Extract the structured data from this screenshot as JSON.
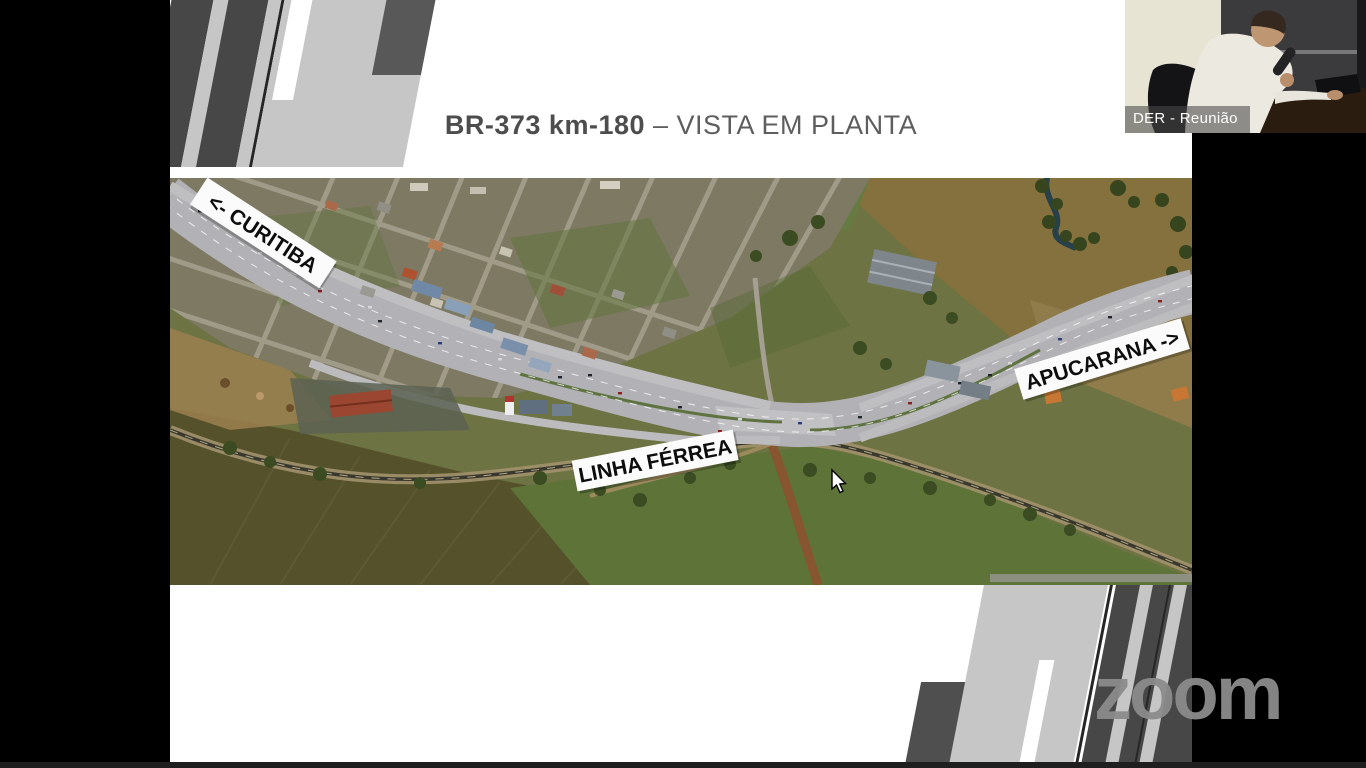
{
  "slide": {
    "title": {
      "highlight": "BR-373 km-180",
      "rest": " – VISTA EM PLANTA"
    },
    "colors": {
      "title_bold": "#4d4d4d",
      "title_rest": "#5e5e5e",
      "deco_dark": "#474747",
      "deco_light": "#c6c6c6"
    }
  },
  "map": {
    "labels": {
      "curitiba": "<- CURITIBA",
      "apucarana": "APUCARANA ->",
      "railway": "LINHA FÉRREA"
    }
  },
  "webcam": {
    "participant": "DER - Reunião"
  },
  "watermark": {
    "text": "zoom"
  }
}
